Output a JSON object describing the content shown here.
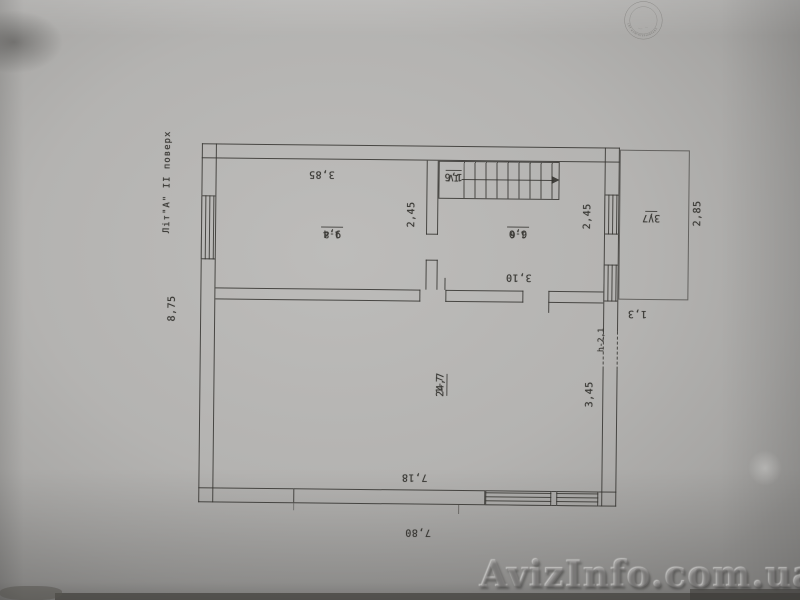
{
  "photo": {
    "watermark_text": "AvizInfo.com.ua",
    "stamp_ring_text": "СБТ КОМІНТЕРНІВСЬКЕ"
  },
  "plan": {
    "floor_label": "Літ\"А\" II поверх",
    "rooms": [
      {
        "number": "1-8",
        "area": "9,4"
      },
      {
        "number": "1-6",
        "area": "6,0"
      },
      {
        "number": "1-7",
        "area": "24,7"
      },
      {
        "number": "IV",
        "area": "1,6"
      },
      {
        "number": "V",
        "area": "3,7"
      }
    ],
    "dimensions": {
      "room18_width": "3,85",
      "room18_depth": "2,45",
      "room16_depth": "2,45",
      "room16_width": "3,10",
      "balcony_depth": "2,85",
      "balcony_offset": "1,3",
      "room17_depth": "3,45",
      "room17_width": "7,18",
      "building_width": "7,80",
      "building_depth": "8,75",
      "door_height": "h-2,1"
    }
  }
}
